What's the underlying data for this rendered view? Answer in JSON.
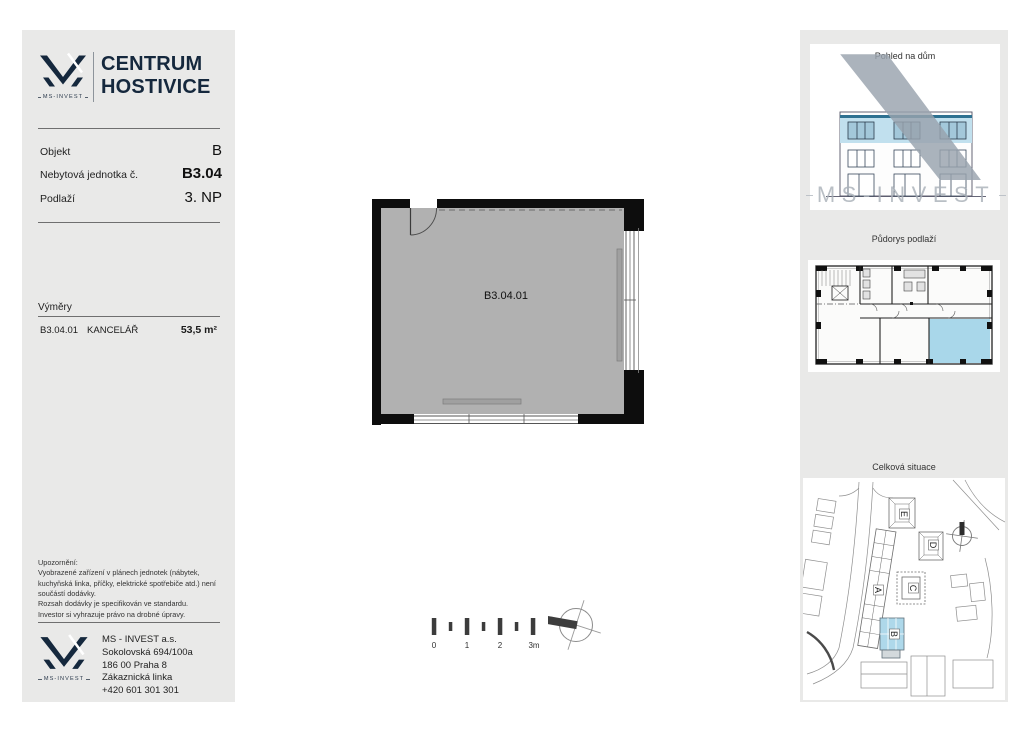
{
  "brand": {
    "name": "MS-INVEST",
    "title_line1": "CENTRUM",
    "title_line2": "HOSTIVICE"
  },
  "colors": {
    "navy": "#15283d",
    "panel_bg": "#e9e9e8",
    "plan_gray": "#b1b1b1",
    "wall_black": "#0d0d0d",
    "highlight_blue": "#aed7ea",
    "watermark_gray": "#99a3ae"
  },
  "unit_info": {
    "rows": [
      {
        "label": "Objekt",
        "value": "B"
      },
      {
        "label": "Nebytová jednotka č.",
        "value": "B3.04"
      },
      {
        "label": "Podlaží",
        "value": "3. NP"
      }
    ]
  },
  "areas": {
    "heading": "Výměry",
    "rows": [
      {
        "code": "B3.04.01",
        "name": "KANCELÁŘ",
        "area": "53,5 m²"
      }
    ]
  },
  "notice": {
    "heading": "Upozornění:",
    "paragraphs": [
      "Vyobrazené zařízení v plánech jednotek (nábytek, kuchyňská linka, příčky, elektrické spotřebiče atd.) není součástí dodávky.",
      "Rozsah dodávky je specifikován ve standardu.",
      "Investor si vyhrazuje právo na drobné úpravy."
    ]
  },
  "company": {
    "lines": [
      "MS - INVEST a.s.",
      "Sokolovská 694/100a",
      "186 00 Praha 8",
      "Zákaznická linka",
      "+420 601 301 301"
    ]
  },
  "plan": {
    "room_label": "B3.04.01"
  },
  "scale_bar": {
    "labels": [
      "0",
      "1",
      "2",
      "3m"
    ]
  },
  "right_panel": {
    "section1_title": "Pohled na dům",
    "section2_title": "Půdorys podlaží",
    "section3_title": "Celková situace",
    "watermark_text": "MS-INVEST",
    "site_labels": [
      "A",
      "B",
      "C",
      "D",
      "E"
    ]
  }
}
